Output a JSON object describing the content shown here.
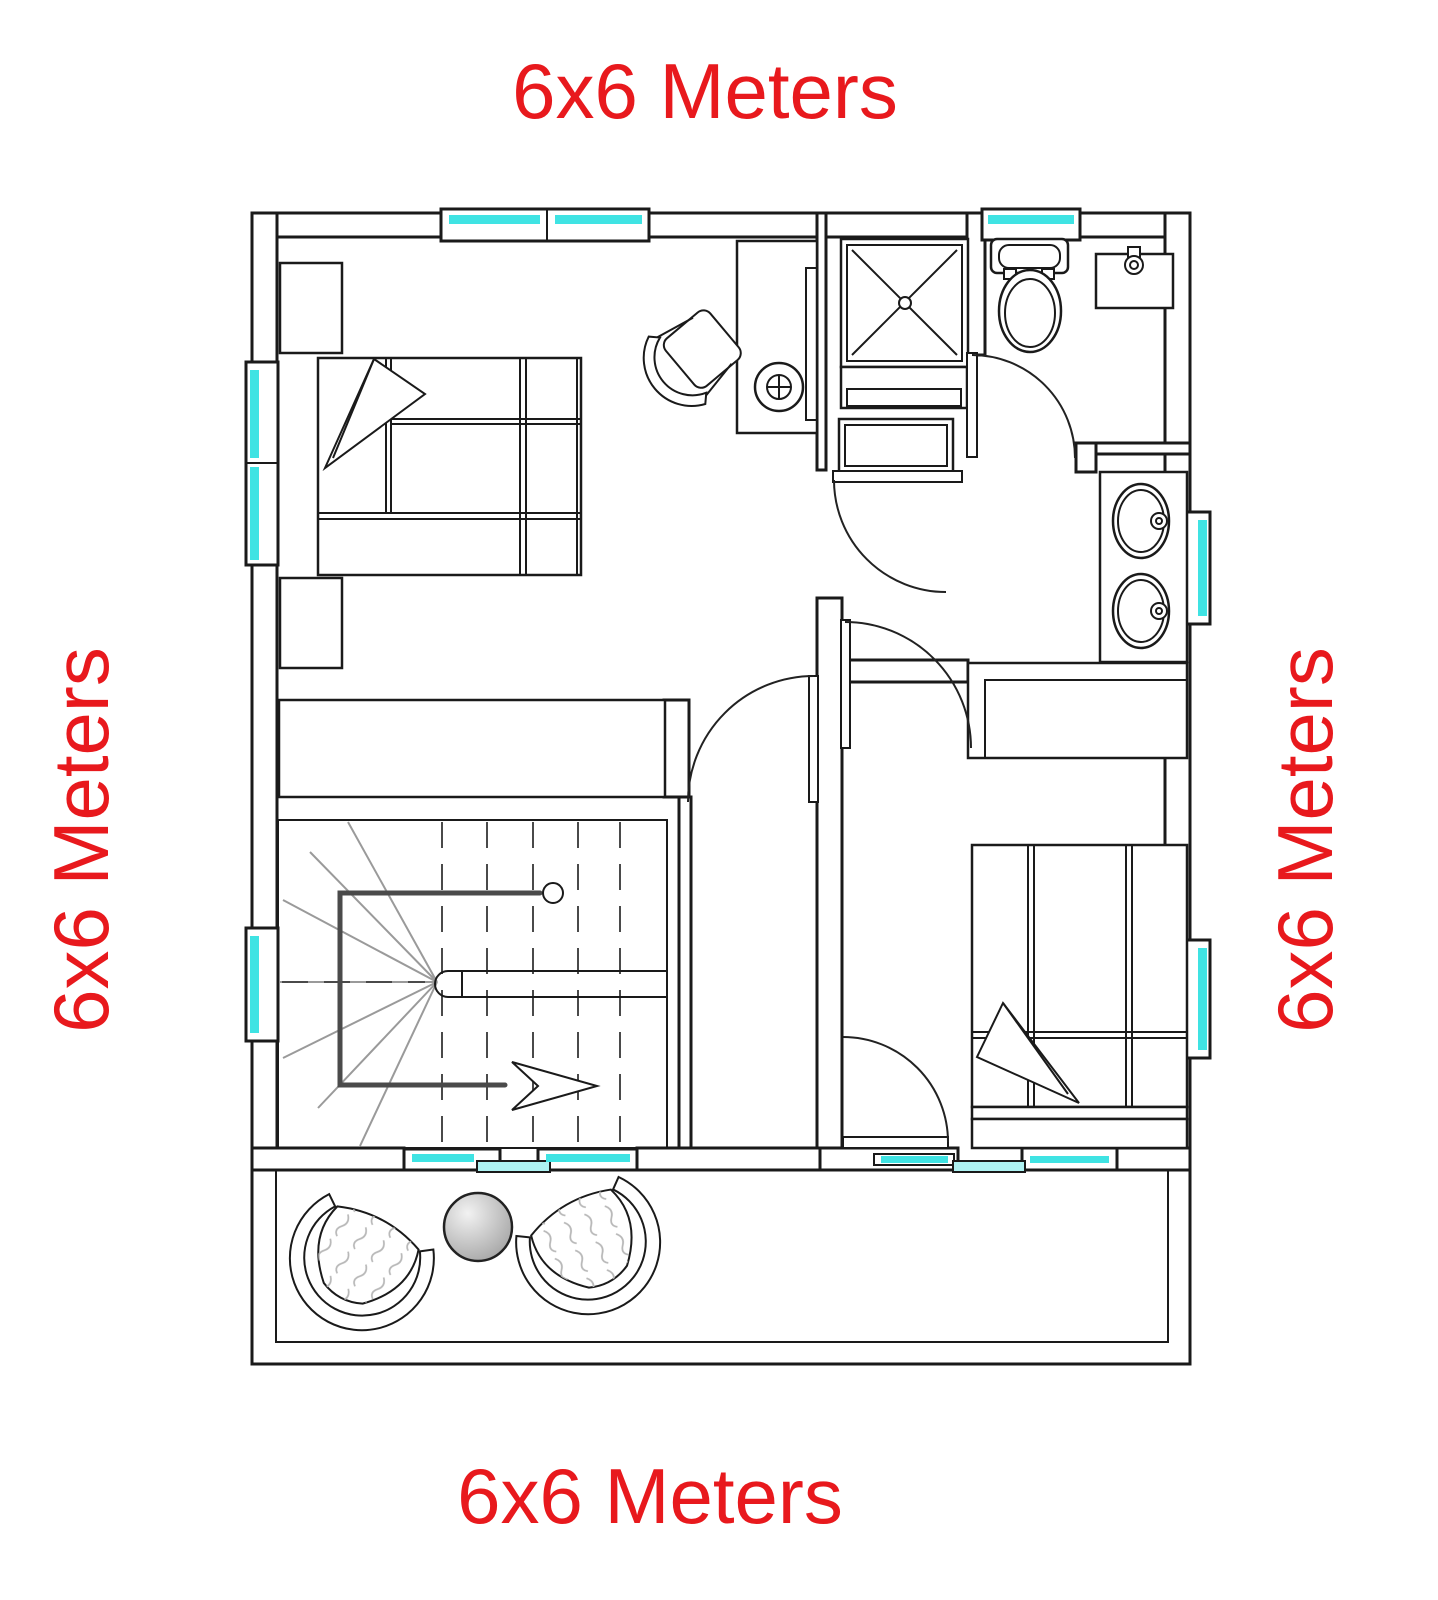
{
  "labels": {
    "top": "6x6 Meters",
    "bottom": "6x6 Meters",
    "left": "6x6 Meters",
    "right": "6x6 Meters"
  },
  "colors": {
    "label-red": "#e8191d",
    "window-cyan": "#3fe3e3",
    "window-cyan-light": "#aef2f2",
    "line": "#1a1a1a",
    "furniture-gray": "#b8b8b8",
    "table-gray": "#9e9e9e"
  }
}
